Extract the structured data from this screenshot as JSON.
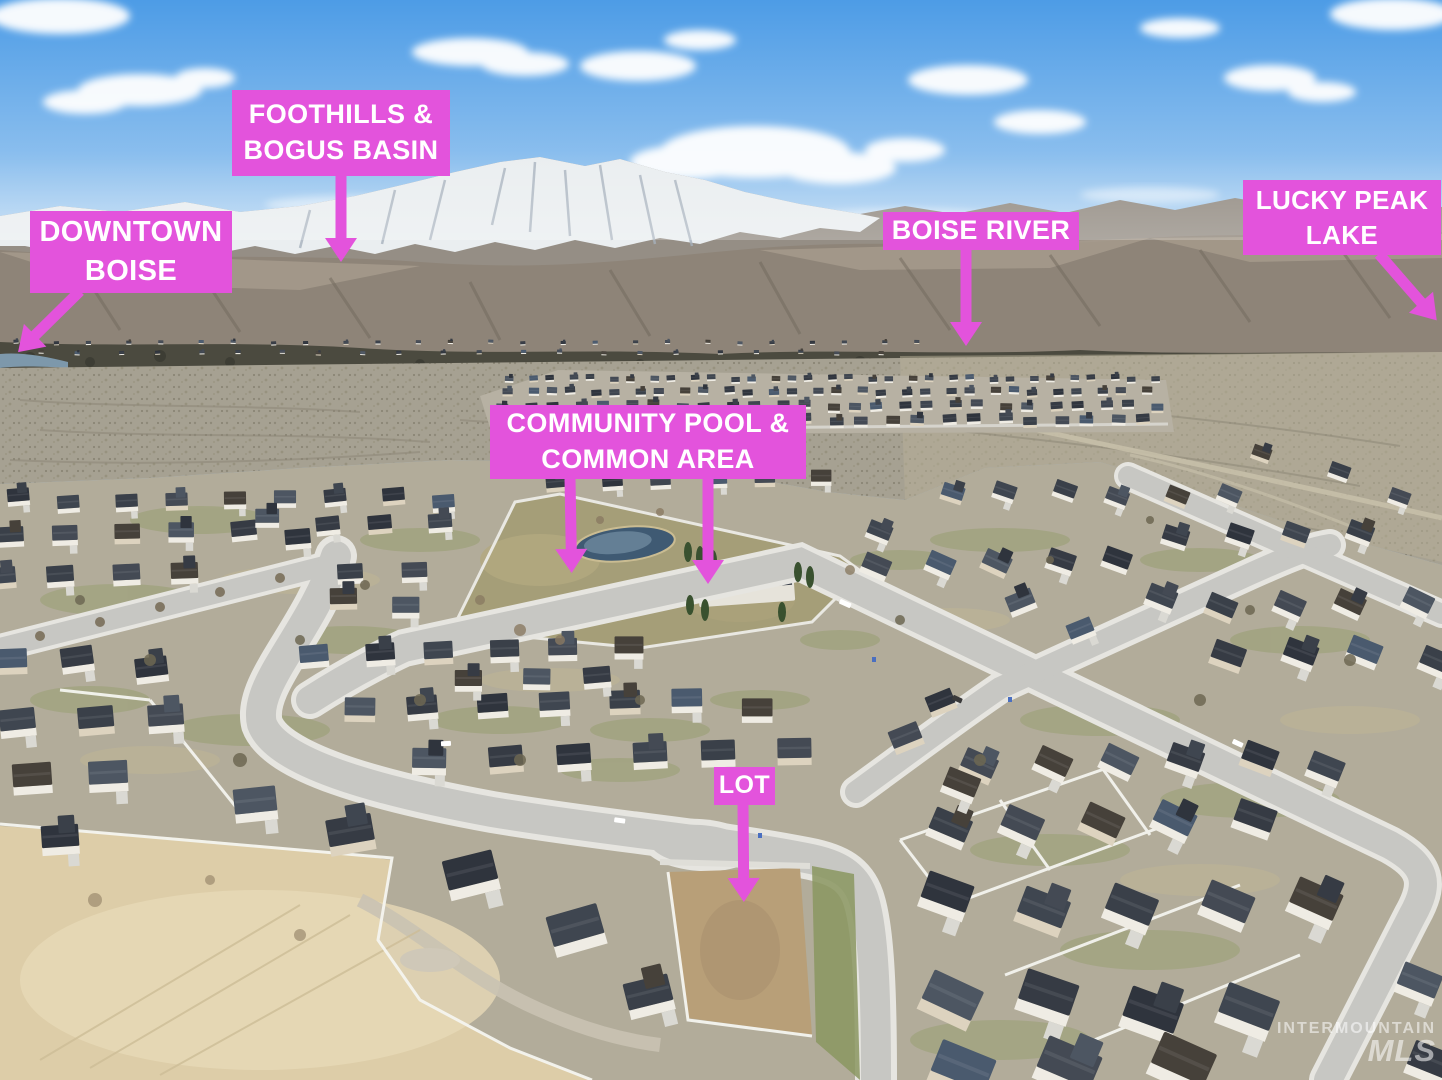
{
  "meta": {
    "title": "Annotated aerial photo of a residential subdivision"
  },
  "colors": {
    "accent": "#e353dc",
    "label_text": "#ffffff"
  },
  "labels": {
    "foothills": {
      "line1": "FOOTHILLS &",
      "line2": "BOGUS BASIN"
    },
    "downtown": {
      "line1": "DOWNTOWN",
      "line2": "BOISE"
    },
    "boise_river": {
      "line1": "BOISE RIVER"
    },
    "lucky_peak": {
      "line1": "LUCKY PEAK",
      "line2": "LAKE"
    },
    "community_pool": {
      "line1": "COMMUNITY POOL &",
      "line2": "COMMON AREA"
    },
    "lot": {
      "line1": "LOT"
    }
  },
  "watermark": {
    "line1": "INTERMOUNTAIN",
    "line2": "MLS"
  }
}
